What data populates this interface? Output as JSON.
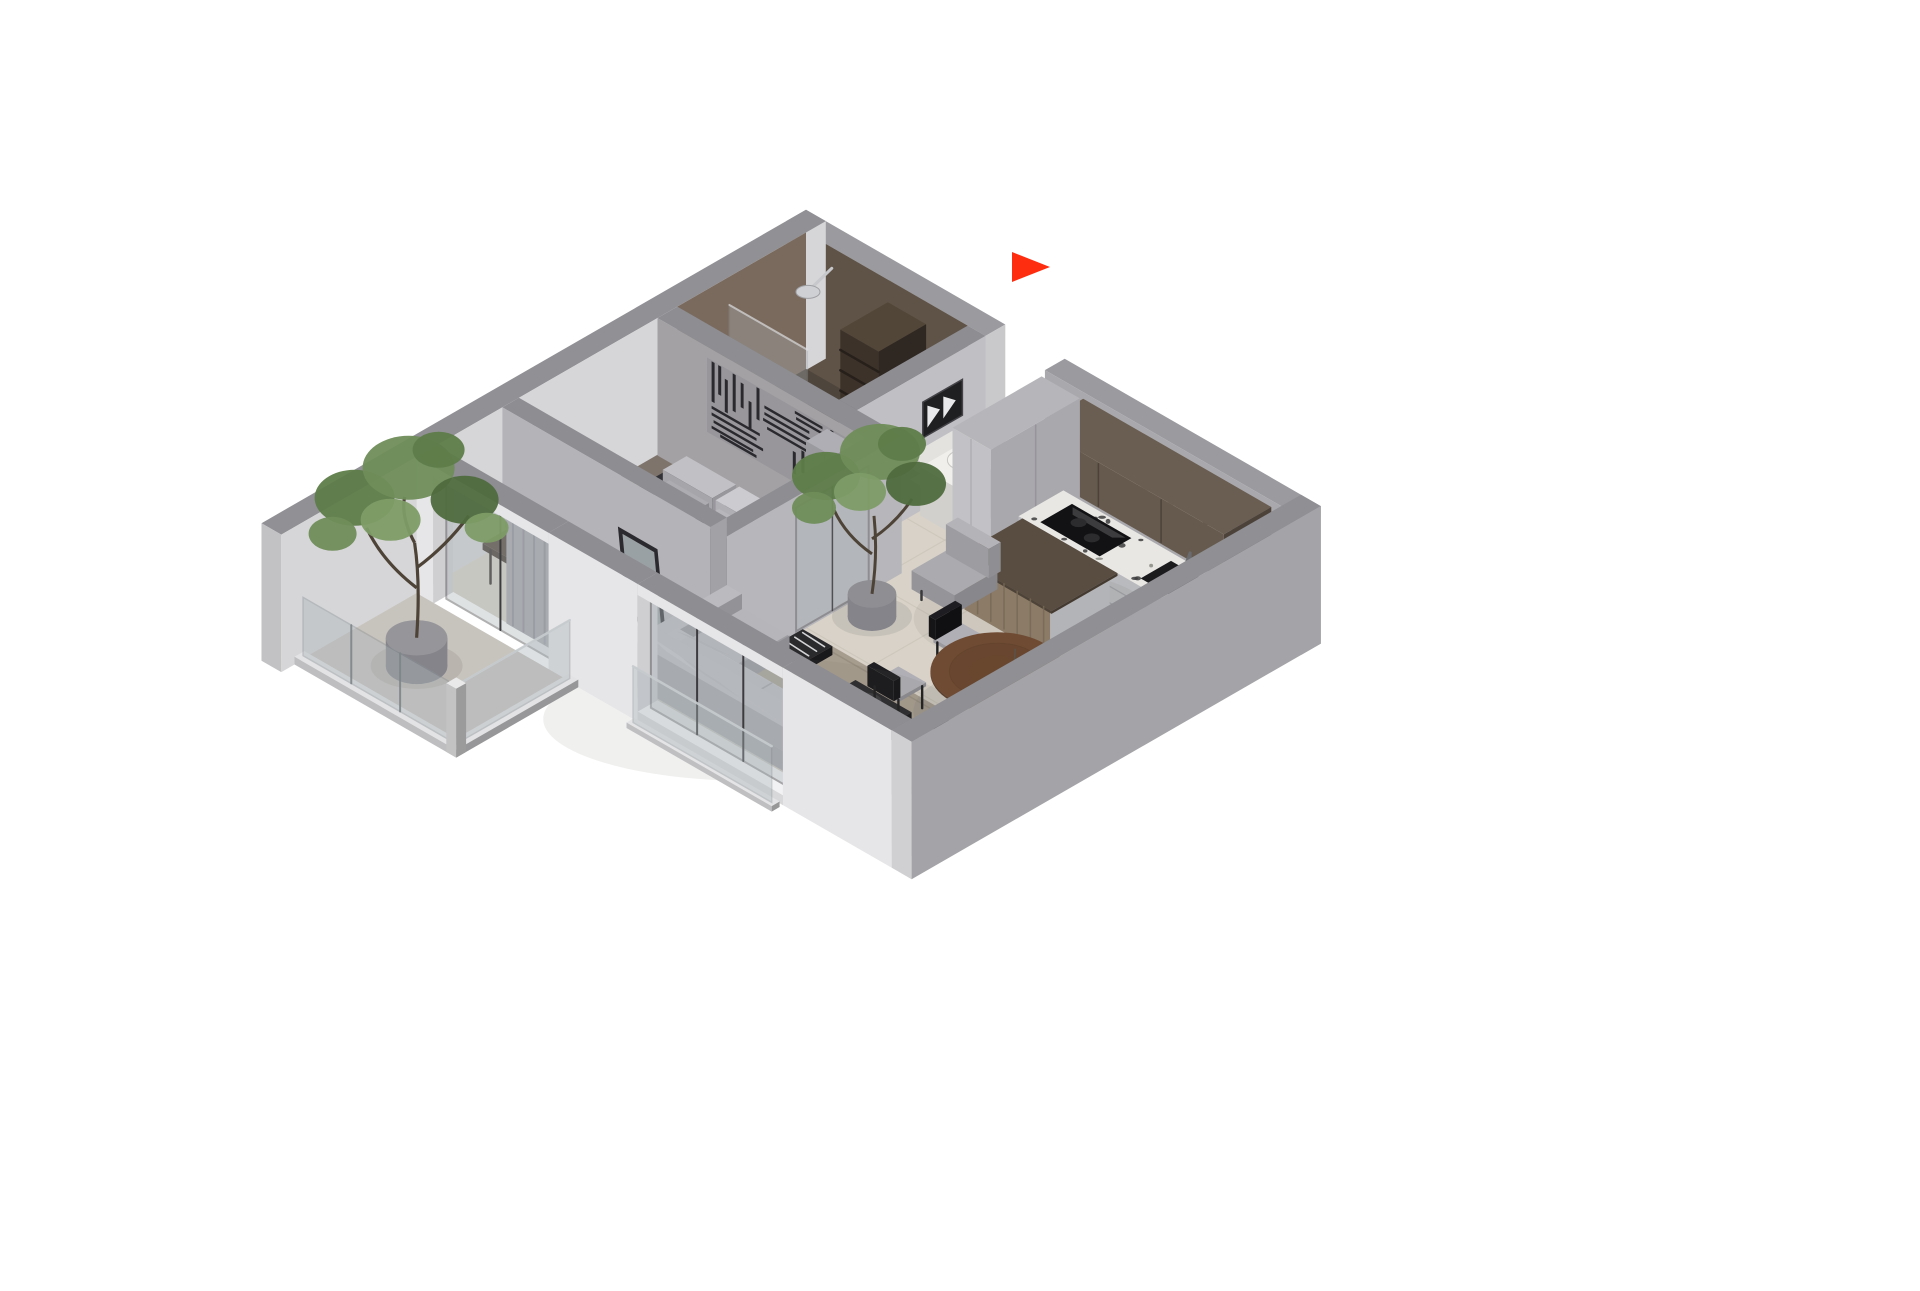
{
  "scene": {
    "type": "isometric-apartment-floorplan-render",
    "background": "#ffffff"
  },
  "marker": {
    "name": "entry-direction-arrow",
    "color": "#ff2d10",
    "direction": "right"
  },
  "rooms": [
    {
      "name": "bathroom"
    },
    {
      "name": "entry-hall"
    },
    {
      "name": "kitchen"
    },
    {
      "name": "bedroom"
    },
    {
      "name": "living-room"
    },
    {
      "name": "dining-area"
    },
    {
      "name": "balcony"
    }
  ],
  "furniture": [
    "double-bed",
    "bed-pillows",
    "headboard-bench",
    "wall-art-panel",
    "wardrobe",
    "mirror",
    "desk",
    "blue-chair",
    "sofa",
    "sofa-pillows",
    "coffee-table",
    "area-rug",
    "floor-cushion",
    "round-dining-table",
    "dining-chairs",
    "kitchen-island",
    "armchair",
    "base-cabinets",
    "upper-cabinets",
    "tall-cabinets",
    "cooktop",
    "kitchen-sink",
    "shower",
    "bathroom-shelf",
    "vanity-sink",
    "framed-art",
    "wall-shelves",
    "potted-tree-balcony",
    "potted-tree-living",
    "curtain",
    "glass-railing",
    "sliding-glass-door"
  ],
  "colors": {
    "arrow": "#ff2d10",
    "wallTop": "#8d8d92",
    "wallTopLight": "#9a9a9f",
    "outerWhite": "#e2e2e4",
    "innerLight": "#d6d6d8",
    "wallGray": "#b3b2b6",
    "hallWall": "#c0bfc3",
    "rightWallOuter": "#a4a4a8",
    "frontWhite": "#e6e6e8",
    "brownWallDark": "#5f5347",
    "brownWallLight": "#7a6a5d",
    "floorMain": "#d8d2c8",
    "grout": "#c9c3b8",
    "floorBedroom": "#7e746b",
    "floorBath": "#584e45",
    "floorBalcony": "#c7c3bd",
    "rug": "#a79d8f",
    "rugEdge": "#998f81",
    "sofa": "#b3b2b7",
    "sofaShadow": "#98979c",
    "pillowLight": "#c6c5ca",
    "pillowMid": "#b1b0b5",
    "duvet": "#2e2d31",
    "duvetFold": "#4c4b51",
    "bedBase": "#3a3733",
    "bench": "#b2b1b6",
    "pillowA": "#b8b7bc",
    "pillowB": "#c2c1c6",
    "artPanelBg": "#98969a",
    "artBar": "#2a292d",
    "wardrobe": "#a7a6ab",
    "mirrorGlass": "#aeb6ba",
    "frameDark": "#2b2a2e",
    "terrazzo": "#e9e7e3",
    "speckA": "#3c3c3e",
    "speckB": "#8a8984",
    "stainless": "#b9babe",
    "stainlessDark": "#a0a1a5",
    "cabinetBrown": "#5d5146",
    "cabinetBrownDark": "#4c423a",
    "tallCab": "#c2c1c5",
    "islandTop": "#594d42",
    "islandWood": "#8b7b67",
    "woodGrain": "#786957",
    "black": "#1a191c",
    "cooktop": "#121214",
    "tableWood": "#6f4b33",
    "tableRim": "#583c29",
    "chairBlack": "#1d1c1f",
    "chairSeat": "#a8a7ac",
    "blueChair": "#4aa2d2",
    "blueChairDark": "#3d92c2",
    "curtain": "#a5a4a9",
    "curtainFold": "#8b8a90",
    "glass": "#aeb7bb",
    "glassFrame": "#45444a",
    "plantA": "#5e7c49",
    "plantB": "#6f8d58",
    "plantC": "#4f6b3e",
    "plantD": "#7d9c66",
    "trunk": "#4e4337",
    "planter": "#96969a",
    "white": "#f2f2f3",
    "shadow": "#6e6a63",
    "desk": "#4a3c31",
    "vanity": "#e4e2de",
    "counterWhite": "#f0efec",
    "step": "#d2cdc3"
  }
}
